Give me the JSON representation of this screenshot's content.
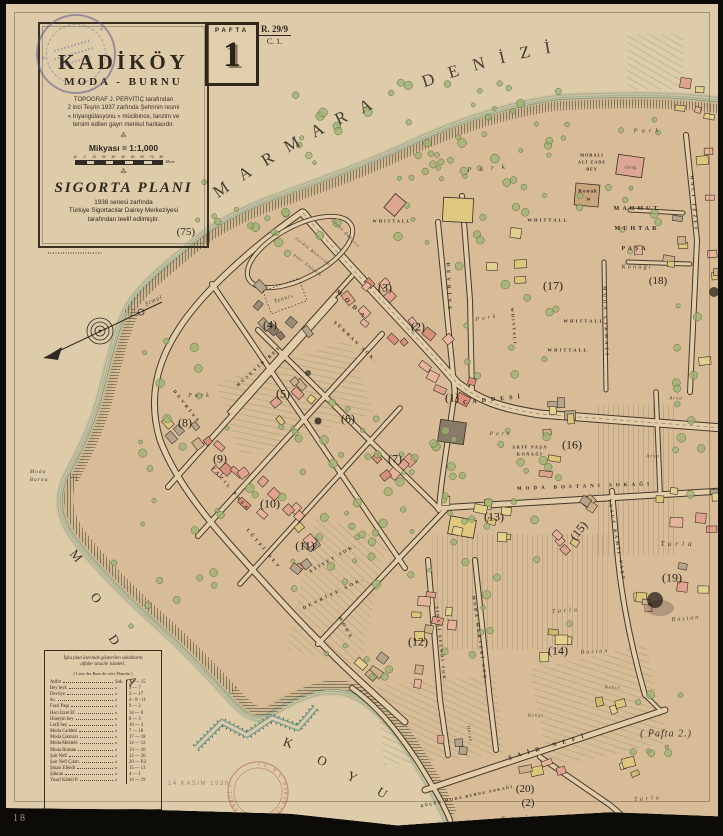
{
  "page_number": "18",
  "archive_stamp_symbol": "✳",
  "title_block": {
    "title": "KADİKÖY",
    "subtitle": "MODA - BURNU",
    "desc": [
      "TOPOGRAF J. PERVİTİÇ tarafından",
      "2 inci Teşrin 1937 zarfında Şehrinin resmi",
      "« triyangülasyonu » mücibince, tanzim ve",
      "tersim edilen gayrı menkul haritasıdır."
    ],
    "separator": "⁂",
    "scale_label": "Mikyası = 1:1,000",
    "scale_ticks": [
      "10",
      "0",
      "10",
      "20",
      "30",
      "40",
      "50",
      "60",
      "70",
      "80"
    ],
    "scale_unit": "Metre",
    "plan_title": "SIGORTA PLANI",
    "plan_desc": [
      "1938 senesi zarfında",
      "Türkiye Sigortacılar Dairey Merkeziyesi",
      "tarafından teelif edilmiştir."
    ],
    "sheet_number": "(75)"
  },
  "pafta": {
    "label": "PAFTA",
    "number": "1"
  },
  "ref": {
    "top": "R. 29/9",
    "bottom": "C. 1."
  },
  "sea": {
    "name": "MARMARA DENİZİ",
    "bay_letters": [
      {
        "t": "M",
        "x": 76,
        "y": 556,
        "rot": 50
      },
      {
        "t": "O",
        "x": 96,
        "y": 598,
        "rot": 54
      },
      {
        "t": "D",
        "x": 114,
        "y": 640,
        "rot": 58
      },
      {
        "t": "A",
        "x": 132,
        "y": 681,
        "rot": 62
      },
      {
        "t": "K",
        "x": 288,
        "y": 743,
        "rot": 20
      },
      {
        "t": "O",
        "x": 322,
        "y": 761,
        "rot": 24
      },
      {
        "t": "Y",
        "x": 352,
        "y": 777,
        "rot": 28
      },
      {
        "t": "U",
        "x": 382,
        "y": 793,
        "rot": 32
      }
    ]
  },
  "pafta2_label": "( Pafta 2.)",
  "date_stamp": "14 KASIM 1938",
  "bottom_stamp": "• G. & A. BAKER LİMİTED • İSTANBUL •",
  "blocks": [
    {
      "t": "(1)",
      "x": 452,
      "y": 398
    },
    {
      "t": "(2)",
      "x": 418,
      "y": 327
    },
    {
      "t": "(3)",
      "x": 385,
      "y": 288
    },
    {
      "t": "(4)",
      "x": 270,
      "y": 325
    },
    {
      "t": "(5)",
      "x": 283,
      "y": 394
    },
    {
      "t": "(6)",
      "x": 348,
      "y": 419
    },
    {
      "t": "(7)",
      "x": 395,
      "y": 459
    },
    {
      "t": "(8)",
      "x": 185,
      "y": 423
    },
    {
      "t": "(9)",
      "x": 220,
      "y": 459
    },
    {
      "t": "(10)",
      "x": 270,
      "y": 504
    },
    {
      "t": "(11)",
      "x": 305,
      "y": 546
    },
    {
      "t": "(12)",
      "x": 418,
      "y": 642
    },
    {
      "t": "(13)",
      "x": 494,
      "y": 517
    },
    {
      "t": "(14)",
      "x": 558,
      "y": 651
    },
    {
      "t": "(15)",
      "x": 579,
      "y": 531,
      "rot": -52
    },
    {
      "t": "(16)",
      "x": 572,
      "y": 445
    },
    {
      "t": "(17)",
      "x": 553,
      "y": 286
    },
    {
      "t": "(18)",
      "x": 658,
      "y": 281,
      "fs": 11
    },
    {
      "t": "(19)",
      "x": 672,
      "y": 578
    },
    {
      "t": "(20)",
      "x": 525,
      "y": 789,
      "fs": 11
    },
    {
      "t": "(2)",
      "x": 528,
      "y": 803,
      "fs": 11
    }
  ],
  "street_labels": [
    {
      "t": "MODA",
      "x": 352,
      "y": 306,
      "rot": 44,
      "fs": 6,
      "ls": 6
    },
    {
      "t": "CADDESİ",
      "x": 494,
      "y": 400,
      "rot": -6,
      "fs": 6,
      "ls": 5
    },
    {
      "t": "DEVRİYE",
      "x": 448,
      "y": 288,
      "rot": 88,
      "fs": 5,
      "ls": 4
    },
    {
      "t": "DEVRİYE SOK.",
      "x": 334,
      "y": 593,
      "rot": -26,
      "fs": 4.6,
      "ls": 3
    },
    {
      "t": "DEVRİYE",
      "x": 187,
      "y": 407,
      "rot": 52,
      "fs": 4.6,
      "ls": 3
    },
    {
      "t": "LÛTFİ BEY",
      "x": 264,
      "y": 549,
      "rot": 50,
      "fs": 4.6,
      "ls": 3
    },
    {
      "t": "FAZIL PAŞA",
      "x": 231,
      "y": 489,
      "rot": 50,
      "fs": 4.6,
      "ls": 3
    },
    {
      "t": "HÜSEYİN BEY",
      "x": 259,
      "y": 366,
      "rot": -42,
      "fs": 4.6,
      "ls": 2.5
    },
    {
      "t": "ŞÜKRAN SOK.",
      "x": 356,
      "y": 342,
      "rot": 44,
      "fs": 4.6,
      "ls": 2.5
    },
    {
      "t": "ATİFET SOK.",
      "x": 333,
      "y": 558,
      "rot": -30,
      "fs": 4.4,
      "ls": 2.5
    },
    {
      "t": "MODA BOSTANI SOKAĞI",
      "x": 585,
      "y": 487,
      "rot": -2,
      "fs": 5,
      "ls": 4
    },
    {
      "t": "MODA ÇIKMAZI",
      "x": 606,
      "y": 322,
      "rot": 88,
      "fs": 4.5,
      "ls": 3
    },
    {
      "t": "HACI İZZET",
      "x": 694,
      "y": 204,
      "rot": 86,
      "fs": 4.6,
      "ls": 3
    },
    {
      "t": "YUSUF KÂMİL PAŞA",
      "x": 617,
      "y": 540,
      "rot": 80,
      "fs": 4.5,
      "ls": 2.5
    },
    {
      "t": "MODA MEKTEBİ SOK.",
      "x": 480,
      "y": 640,
      "rot": 82,
      "fs": 4.4,
      "ls": 2.5
    },
    {
      "t": "ŞİNASİ EFENDİ SOK.",
      "x": 441,
      "y": 645,
      "rot": 84,
      "fs": 4.2,
      "ls": 2
    },
    {
      "t": "ŞAİR NEFİ",
      "x": 549,
      "y": 747,
      "rot": -16,
      "fs": 6,
      "ls": 6
    },
    {
      "t": "MODA",
      "x": 346,
      "y": 628,
      "rot": 60,
      "fs": 4.6,
      "ls": 3
    },
    {
      "t": "KÜÇÜK MODA BURNU SOKAĞI",
      "x": 467,
      "y": 796,
      "rot": -12,
      "fs": 4,
      "ls": 1.5
    }
  ],
  "area_labels": [
    {
      "t": "Park",
      "x": 490,
      "y": 168,
      "rot": -5,
      "fs": 7,
      "ls": 8,
      "cls": "it"
    },
    {
      "t": "Park",
      "x": 648,
      "y": 131,
      "rot": 0,
      "fs": 6.5,
      "ls": 4,
      "cls": "it"
    },
    {
      "t": "Park",
      "x": 200,
      "y": 396,
      "rot": 0,
      "fs": 6,
      "ls": 3,
      "cls": "it"
    },
    {
      "t": "Park",
      "x": 501,
      "y": 434,
      "rot": 0,
      "fs": 5.5,
      "ls": 3,
      "cls": "it"
    },
    {
      "t": "Park",
      "x": 487,
      "y": 318,
      "rot": -10,
      "fs": 5.5,
      "ls": 3,
      "cls": "it"
    },
    {
      "t": "WHITTALL",
      "x": 548,
      "y": 220,
      "rot": 0,
      "fs": 4.6,
      "ls": 2,
      "cls": "es"
    },
    {
      "t": "WHITTALL",
      "x": 584,
      "y": 321,
      "rot": 0,
      "fs": 4.6,
      "ls": 2,
      "cls": "es"
    },
    {
      "t": "WHITTALL",
      "x": 568,
      "y": 350,
      "rot": 0,
      "fs": 4.6,
      "ls": 2,
      "cls": "es"
    },
    {
      "t": "WHITTALL",
      "x": 514,
      "y": 327,
      "rot": 85,
      "fs": 4.2,
      "ls": 2,
      "cls": "es"
    },
    {
      "t": "WHITTALL",
      "x": 392,
      "y": 221,
      "rot": 0,
      "fs": 4.2,
      "ls": 2,
      "cls": "es"
    },
    {
      "t": "MORALI",
      "x": 592,
      "y": 155,
      "rot": 0,
      "fs": 4.2,
      "ls": 1,
      "cls": "es"
    },
    {
      "t": "ALİ ZADE",
      "x": 592,
      "y": 162,
      "rot": 0,
      "fs": 4.2,
      "ls": 1,
      "cls": "es"
    },
    {
      "t": "BEY",
      "x": 592,
      "y": 169,
      "rot": 0,
      "fs": 4.2,
      "ls": 1,
      "cls": "es"
    },
    {
      "t": "Garag.",
      "x": 631,
      "y": 167,
      "rot": 0,
      "fs": 4.5,
      "ls": 0,
      "cls": "it"
    },
    {
      "t": "Konak",
      "x": 588,
      "y": 192,
      "rot": 0,
      "fs": 5,
      "ls": 1,
      "cls": "es"
    },
    {
      "t": "34",
      "x": 588,
      "y": 199,
      "rot": 0,
      "fs": 4,
      "ls": 0,
      "cls": "es"
    },
    {
      "t": "MAHMUT",
      "x": 637,
      "y": 209,
      "rot": 0,
      "fs": 6,
      "ls": 3,
      "cls": "es"
    },
    {
      "t": "MUHTAR",
      "x": 637,
      "y": 229,
      "rot": 0,
      "fs": 6,
      "ls": 3,
      "cls": "es"
    },
    {
      "t": "PAŞA",
      "x": 635,
      "y": 249,
      "rot": 0,
      "fs": 6,
      "ls": 3,
      "cls": "es"
    },
    {
      "t": "Konağı",
      "x": 637,
      "y": 267,
      "rot": 0,
      "fs": 6.5,
      "ls": 2,
      "cls": "it"
    },
    {
      "t": "AKİF PAŞA",
      "x": 530,
      "y": 447,
      "rot": 0,
      "fs": 4.2,
      "ls": 1.5,
      "cls": "es"
    },
    {
      "t": "KONAĞI",
      "x": 530,
      "y": 454,
      "rot": 0,
      "fs": 4.2,
      "ls": 1.5,
      "cls": "es"
    },
    {
      "t": "Tennis",
      "x": 284,
      "y": 299,
      "rot": -18,
      "fs": 5.5,
      "ls": 1,
      "cls": "it"
    },
    {
      "t": "Çocuk Bahçesi",
      "x": 346,
      "y": 233,
      "rot": 46,
      "fs": 4.4,
      "ls": 1,
      "cls": "it"
    },
    {
      "t": "Jardin Municipal",
      "x": 314,
      "y": 252,
      "rot": 38,
      "fs": 4.4,
      "ls": 1,
      "cls": "it"
    },
    {
      "t": "pour Enfants",
      "x": 308,
      "y": 265,
      "rot": 38,
      "fs": 4.4,
      "ls": 1,
      "cls": "it"
    },
    {
      "t": "Tarla",
      "x": 678,
      "y": 544,
      "rot": 0,
      "fs": 7,
      "ls": 4,
      "cls": "it"
    },
    {
      "t": "Tarla",
      "x": 566,
      "y": 611,
      "rot": -4,
      "fs": 6,
      "ls": 3,
      "cls": "it"
    },
    {
      "t": "Tarla",
      "x": 648,
      "y": 799,
      "rot": -4,
      "fs": 6,
      "ls": 3,
      "cls": "it"
    },
    {
      "t": "Tarla",
      "x": 521,
      "y": 818,
      "rot": -4,
      "fs": 7,
      "ls": 5,
      "cls": "it"
    },
    {
      "t": "Bostan",
      "x": 686,
      "y": 619,
      "rot": -5,
      "fs": 6,
      "ls": 2,
      "cls": "it"
    },
    {
      "t": "Bostan",
      "x": 595,
      "y": 652,
      "rot": -3,
      "fs": 6,
      "ls": 2,
      "cls": "it"
    },
    {
      "t": "Bahçe",
      "x": 536,
      "y": 715,
      "rot": 0,
      "fs": 4.5,
      "ls": 1,
      "cls": "it"
    },
    {
      "t": "Bahçe",
      "x": 613,
      "y": 687,
      "rot": 0,
      "fs": 4.5,
      "ls": 1,
      "cls": "it"
    },
    {
      "t": "Arsa",
      "x": 676,
      "y": 399,
      "rot": 0,
      "fs": 5,
      "ls": 1,
      "cls": "it"
    },
    {
      "t": "Arsa",
      "x": 653,
      "y": 457,
      "rot": 0,
      "fs": 5,
      "ls": 1,
      "cls": "it"
    },
    {
      "t": "Harap",
      "x": 470,
      "y": 734,
      "rot": 80,
      "fs": 4.4,
      "ls": 1,
      "cls": "it"
    },
    {
      "t": "Moda",
      "x": 38,
      "y": 472,
      "rot": 0,
      "fs": 5.5,
      "ls": 1,
      "cls": "it"
    },
    {
      "t": "Burnu",
      "x": 39,
      "y": 480,
      "rot": 0,
      "fs": 5.5,
      "ls": 1,
      "cls": "it"
    },
    {
      "t": "Şimal",
      "x": 154,
      "y": 301,
      "rot": -24,
      "fs": 6,
      "ls": 1,
      "cls": "it"
    },
    {
      "t": "( Pafta 2.)",
      "x": 666,
      "y": 734,
      "rot": 0,
      "fs": 10,
      "ls": 1,
      "cls": "pf"
    }
  ],
  "legend": {
    "h1": "İşbu plan üzerinde gösterilen sokakların",
    "h2": "alfabe sırasile isimleri.",
    "h3": "( Liste des Rues de cette Planche )",
    "rows": [
      {
        "n": "Atifet",
        "c": "Sok.",
        "v": "12 — 15"
      },
      {
        "n": "Bey leyk",
        "c": "»",
        "v": "9 — 7"
      },
      {
        "n": "Devriye",
        "c": "»",
        "v": "2 — 17"
      },
      {
        "n": "  do.",
        "c": "»",
        "v": "4 - 8 - 11"
      },
      {
        "n": "Fazıl Paşa",
        "c": "»",
        "v": "9 — 2"
      },
      {
        "n": "Hacı İzzet Ef.",
        "c": "»",
        "v": "14 — 8"
      },
      {
        "n": "Hüseyin bey",
        "c": "»",
        "v": "8 — 3"
      },
      {
        "n": "Lutfi bey",
        "c": "»",
        "v": "10 — 3"
      },
      {
        "n": "Moda Caddesi",
        "c": "»",
        "v": "7 — 18"
      },
      {
        "n": "Moda Çıkmazı",
        "c": "»",
        "v": "17 — 18"
      },
      {
        "n": "Moda Mektebi",
        "c": "»",
        "v": "14 — 12"
      },
      {
        "n": "Moda Bostanı",
        "c": "»",
        "v": "13 — 16"
      },
      {
        "n": "Şair Nefi",
        "c": "»",
        "v": "12 — 20"
      },
      {
        "n": "Şair Nefi Çıkm.",
        "c": "»",
        "v": "20 — P.2"
      },
      {
        "n": "Şinasi Efendi",
        "c": "»",
        "v": "15 — 13"
      },
      {
        "n": "Şükran",
        "c": "»",
        "v": "4 — 1"
      },
      {
        "n": "Yusuf Kâmil P.",
        "c": "»",
        "v": "14 — 19"
      }
    ]
  }
}
